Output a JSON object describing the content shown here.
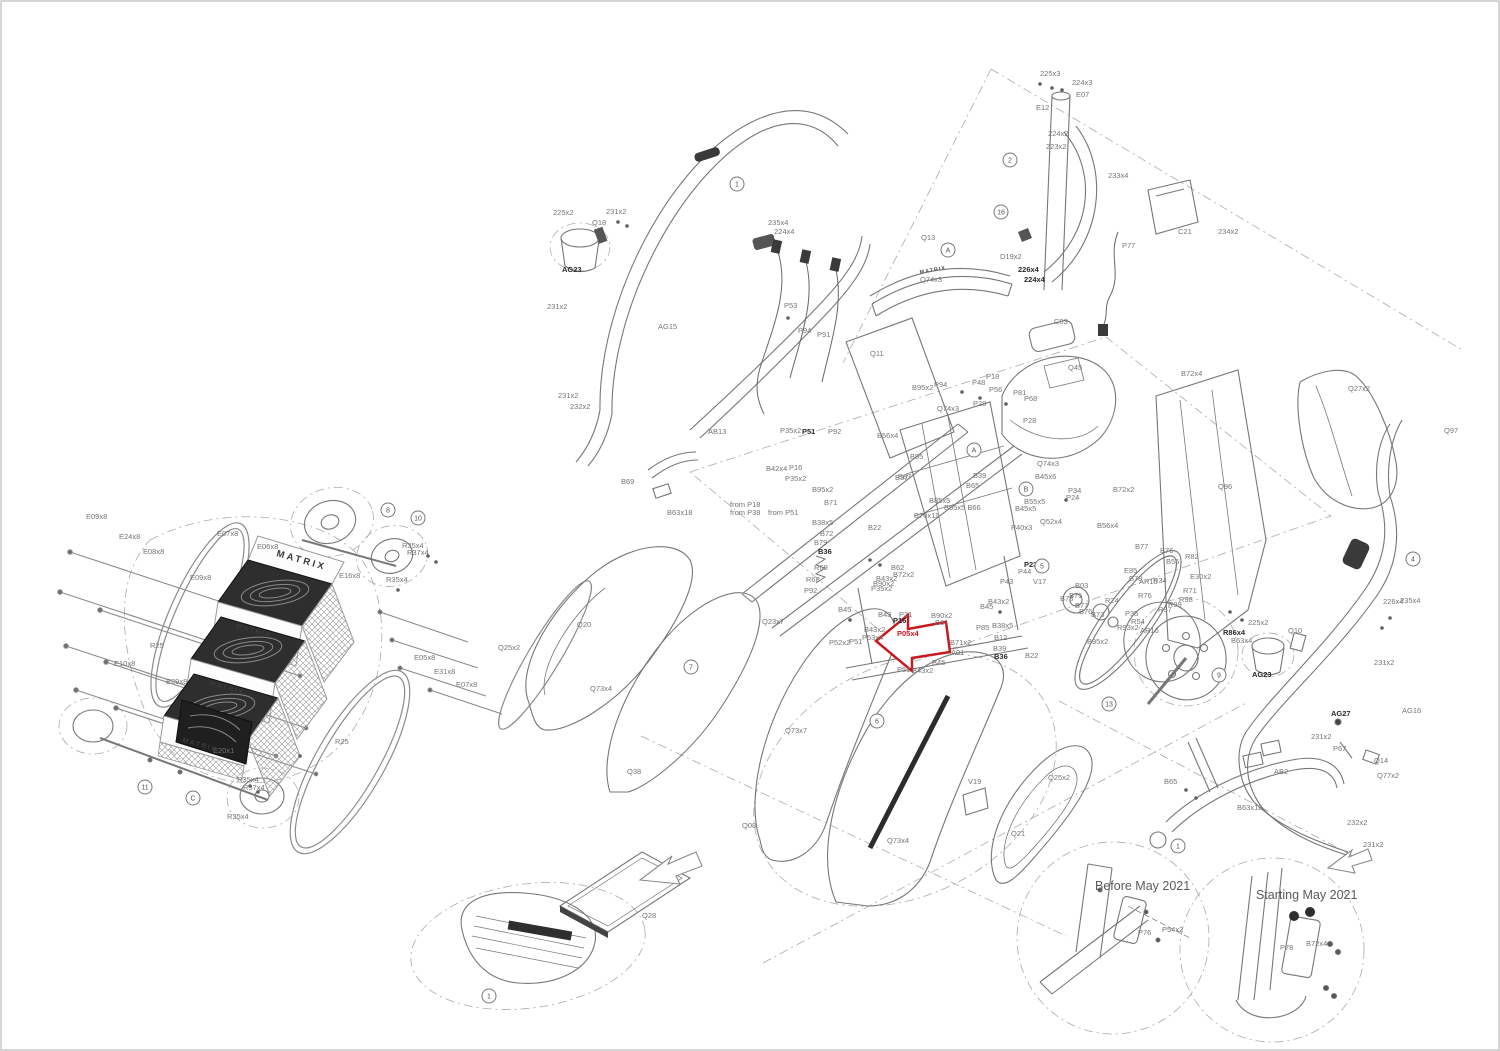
{
  "title": "Matrix stair climber - exploded parts diagram",
  "colors": {
    "line": "#777777",
    "label": "#757575",
    "bold": "#2a2a2a",
    "highlight": "#c8191f",
    "border": "#c9c9c9",
    "dark_fill": "#2e2e2e"
  },
  "highlight_arrow": {
    "points": "876,641 908,615 908,629 946,622 950,652 912,658 912,671"
  },
  "labels": [
    {
      "t": "225x3",
      "x": 1040,
      "y": 76
    },
    {
      "t": "224x3",
      "x": 1072,
      "y": 85
    },
    {
      "t": "E07",
      "x": 1076,
      "y": 97
    },
    {
      "t": "E12",
      "x": 1036,
      "y": 110
    },
    {
      "t": "224x2",
      "x": 1048,
      "y": 136
    },
    {
      "t": "223x2",
      "x": 1046,
      "y": 149
    },
    {
      "t": "233x4",
      "x": 1108,
      "y": 178
    },
    {
      "t": "C21",
      "x": 1178,
      "y": 234
    },
    {
      "t": "234x2",
      "x": 1218,
      "y": 234
    },
    {
      "t": "P77",
      "x": 1122,
      "y": 248
    },
    {
      "t": "D19x2",
      "x": 1000,
      "y": 259
    },
    {
      "t": "226x4",
      "x": 1018,
      "y": 272,
      "cls": "b"
    },
    {
      "t": "224x4",
      "x": 1024,
      "y": 282,
      "cls": "b"
    },
    {
      "t": "225x2",
      "x": 553,
      "y": 215
    },
    {
      "t": "231x2",
      "x": 606,
      "y": 214
    },
    {
      "t": "Q18",
      "x": 592,
      "y": 225
    },
    {
      "t": "235x4",
      "x": 768,
      "y": 225
    },
    {
      "t": "224x4",
      "x": 774,
      "y": 234
    },
    {
      "t": "AG23",
      "x": 562,
      "y": 272,
      "cls": "b"
    },
    {
      "t": "231x2",
      "x": 547,
      "y": 309
    },
    {
      "t": "AG15",
      "x": 658,
      "y": 329
    },
    {
      "t": "P53",
      "x": 784,
      "y": 308
    },
    {
      "t": "P94",
      "x": 798,
      "y": 333
    },
    {
      "t": "P91",
      "x": 817,
      "y": 337
    },
    {
      "t": "231x2",
      "x": 558,
      "y": 398
    },
    {
      "t": "232x2",
      "x": 570,
      "y": 409
    },
    {
      "t": "Q13",
      "x": 921,
      "y": 240
    },
    {
      "t": "Q74x3",
      "x": 920,
      "y": 282
    },
    {
      "t": "Q11",
      "x": 870,
      "y": 356
    },
    {
      "t": "C03",
      "x": 1054,
      "y": 324
    },
    {
      "t": "Q45",
      "x": 1068,
      "y": 370
    },
    {
      "t": "B95x2",
      "x": 912,
      "y": 390
    },
    {
      "t": "P94",
      "x": 934,
      "y": 387
    },
    {
      "t": "P48",
      "x": 972,
      "y": 385
    },
    {
      "t": "P18",
      "x": 986,
      "y": 379
    },
    {
      "t": "P56",
      "x": 989,
      "y": 392
    },
    {
      "t": "P81",
      "x": 1013,
      "y": 395
    },
    {
      "t": "P68",
      "x": 1024,
      "y": 401
    },
    {
      "t": "P28",
      "x": 973,
      "y": 406
    },
    {
      "t": "P28",
      "x": 1023,
      "y": 423
    },
    {
      "t": "B72x4",
      "x": 1181,
      "y": 376
    },
    {
      "t": "Q27x2",
      "x": 1348,
      "y": 391
    },
    {
      "t": "Q97",
      "x": 1444,
      "y": 433
    },
    {
      "t": "Q96",
      "x": 1218,
      "y": 489
    },
    {
      "t": "B72x2",
      "x": 1113,
      "y": 492
    },
    {
      "t": "AB13",
      "x": 708,
      "y": 434
    },
    {
      "t": "P35x2",
      "x": 780,
      "y": 433
    },
    {
      "t": "P51",
      "x": 802,
      "y": 434,
      "cls": "b"
    },
    {
      "t": "P92",
      "x": 828,
      "y": 434
    },
    {
      "t": "B56x4",
      "x": 877,
      "y": 438
    },
    {
      "t": "Q74x3",
      "x": 937,
      "y": 411
    },
    {
      "t": "B42x4",
      "x": 766,
      "y": 471
    },
    {
      "t": "P16",
      "x": 789,
      "y": 470
    },
    {
      "t": "P35x2",
      "x": 785,
      "y": 481
    },
    {
      "t": "B95x2",
      "x": 812,
      "y": 492
    },
    {
      "t": "B71",
      "x": 824,
      "y": 505
    },
    {
      "t": "from P18",
      "x": 730,
      "y": 507
    },
    {
      "t": "from P38",
      "x": 730,
      "y": 515
    },
    {
      "t": "from P51",
      "x": 768,
      "y": 515
    },
    {
      "t": "B38x5",
      "x": 812,
      "y": 525
    },
    {
      "t": "B72",
      "x": 820,
      "y": 536
    },
    {
      "t": "B79",
      "x": 814,
      "y": 545
    },
    {
      "t": "B36",
      "x": 818,
      "y": 554,
      "cls": "b"
    },
    {
      "t": "B37",
      "x": 895,
      "y": 480
    },
    {
      "t": "B22",
      "x": 868,
      "y": 530
    },
    {
      "t": "R69",
      "x": 814,
      "y": 570
    },
    {
      "t": "R68",
      "x": 806,
      "y": 582
    },
    {
      "t": "P92",
      "x": 804,
      "y": 593
    },
    {
      "t": "B95",
      "x": 910,
      "y": 459
    },
    {
      "t": "B87",
      "x": 898,
      "y": 479
    },
    {
      "t": "B85x5",
      "x": 929,
      "y": 503
    },
    {
      "t": "B55x5 B66",
      "x": 944,
      "y": 510
    },
    {
      "t": "B70x11",
      "x": 914,
      "y": 518
    },
    {
      "t": "B39",
      "x": 973,
      "y": 478
    },
    {
      "t": "B65",
      "x": 966,
      "y": 488
    },
    {
      "t": "Q74x3",
      "x": 1037,
      "y": 466
    },
    {
      "t": "B45x6",
      "x": 1035,
      "y": 479
    },
    {
      "t": "P34",
      "x": 1068,
      "y": 493
    },
    {
      "t": "P24",
      "x": 1066,
      "y": 500
    },
    {
      "t": "B55x5",
      "x": 1024,
      "y": 504
    },
    {
      "t": "B45x5",
      "x": 1015,
      "y": 511
    },
    {
      "t": "Q52x4",
      "x": 1040,
      "y": 524
    },
    {
      "t": "P40x3",
      "x": 1011,
      "y": 530
    },
    {
      "t": "B56x4",
      "x": 1097,
      "y": 528
    },
    {
      "t": "B62",
      "x": 891,
      "y": 570
    },
    {
      "t": "B72x2",
      "x": 893,
      "y": 577
    },
    {
      "t": "B43x2",
      "x": 876,
      "y": 581
    },
    {
      "t": "B90x2",
      "x": 873,
      "y": 586
    },
    {
      "t": "P35x2",
      "x": 871,
      "y": 591
    },
    {
      "t": "B45",
      "x": 838,
      "y": 612
    },
    {
      "t": "B43",
      "x": 878,
      "y": 617
    },
    {
      "t": "P31",
      "x": 899,
      "y": 617
    },
    {
      "t": "P16",
      "x": 893,
      "y": 623,
      "cls": "b"
    },
    {
      "t": "B90x2",
      "x": 931,
      "y": 618
    },
    {
      "t": "B61",
      "x": 935,
      "y": 625
    },
    {
      "t": "B43x2",
      "x": 864,
      "y": 632
    },
    {
      "t": "P53x4",
      "x": 862,
      "y": 640
    },
    {
      "t": "P05x4",
      "x": 897,
      "y": 636,
      "cls": "red"
    },
    {
      "t": "P52x2",
      "x": 829,
      "y": 645
    },
    {
      "t": "P51",
      "x": 849,
      "y": 644
    },
    {
      "t": "P51",
      "x": 897,
      "y": 672
    },
    {
      "t": "B43x2",
      "x": 912,
      "y": 673
    },
    {
      "t": "B45",
      "x": 932,
      "y": 665
    },
    {
      "t": "A01",
      "x": 951,
      "y": 655
    },
    {
      "t": "B71x2",
      "x": 950,
      "y": 645
    },
    {
      "t": "B43x2",
      "x": 988,
      "y": 604
    },
    {
      "t": "B45",
      "x": 980,
      "y": 609
    },
    {
      "t": "P85",
      "x": 976,
      "y": 630
    },
    {
      "t": "B38x5",
      "x": 992,
      "y": 628
    },
    {
      "t": "B12",
      "x": 994,
      "y": 640
    },
    {
      "t": "B39",
      "x": 993,
      "y": 651
    },
    {
      "t": "B36",
      "x": 994,
      "y": 659,
      "cls": "b"
    },
    {
      "t": "B22",
      "x": 1025,
      "y": 658
    },
    {
      "t": "P23",
      "x": 1024,
      "y": 567,
      "cls": "b"
    },
    {
      "t": "P44",
      "x": 1018,
      "y": 574
    },
    {
      "t": "P43",
      "x": 1000,
      "y": 584
    },
    {
      "t": "V17",
      "x": 1033,
      "y": 584
    },
    {
      "t": "B03",
      "x": 1075,
      "y": 588
    },
    {
      "t": "R24",
      "x": 1105,
      "y": 603
    },
    {
      "t": "B78",
      "x": 1060,
      "y": 601
    },
    {
      "t": "B75",
      "x": 1069,
      "y": 598
    },
    {
      "t": "B77",
      "x": 1075,
      "y": 608
    },
    {
      "t": "B76",
      "x": 1079,
      "y": 614
    },
    {
      "t": "B73",
      "x": 1091,
      "y": 617
    },
    {
      "t": "B77",
      "x": 1135,
      "y": 549
    },
    {
      "t": "B76",
      "x": 1160,
      "y": 553
    },
    {
      "t": "B55",
      "x": 1166,
      "y": 564
    },
    {
      "t": "R82",
      "x": 1185,
      "y": 559
    },
    {
      "t": "E85",
      "x": 1124,
      "y": 573
    },
    {
      "t": "B78",
      "x": 1129,
      "y": 581
    },
    {
      "t": "AR15",
      "x": 1139,
      "y": 584
    },
    {
      "t": "R34",
      "x": 1153,
      "y": 583
    },
    {
      "t": "E30x2",
      "x": 1190,
      "y": 579
    },
    {
      "t": "R71",
      "x": 1183,
      "y": 593
    },
    {
      "t": "R98",
      "x": 1179,
      "y": 602
    },
    {
      "t": "R99",
      "x": 1168,
      "y": 607
    },
    {
      "t": "R76",
      "x": 1138,
      "y": 598
    },
    {
      "t": "R97",
      "x": 1158,
      "y": 612
    },
    {
      "t": "P35",
      "x": 1125,
      "y": 616
    },
    {
      "t": "R54",
      "x": 1131,
      "y": 624
    },
    {
      "t": "AR16",
      "x": 1140,
      "y": 633
    },
    {
      "t": "R93x2",
      "x": 1117,
      "y": 630
    },
    {
      "t": "B95x2",
      "x": 1087,
      "y": 644
    },
    {
      "t": "R86x4",
      "x": 1223,
      "y": 635,
      "cls": "b"
    },
    {
      "t": "B63x4",
      "x": 1231,
      "y": 643
    },
    {
      "t": "225x2",
      "x": 1248,
      "y": 625
    },
    {
      "t": "Q10",
      "x": 1288,
      "y": 633
    },
    {
      "t": "AG23",
      "x": 1252,
      "y": 677,
      "cls": "b"
    },
    {
      "t": "226x4",
      "x": 1383,
      "y": 604
    },
    {
      "t": "235x4",
      "x": 1400,
      "y": 603
    },
    {
      "t": "231x2",
      "x": 1374,
      "y": 665
    },
    {
      "t": "AG27",
      "x": 1331,
      "y": 716,
      "cls": "b"
    },
    {
      "t": "AG16",
      "x": 1402,
      "y": 713
    },
    {
      "t": "231x2",
      "x": 1311,
      "y": 739
    },
    {
      "t": "P67",
      "x": 1333,
      "y": 751
    },
    {
      "t": "Q14",
      "x": 1374,
      "y": 763
    },
    {
      "t": "Q77x2",
      "x": 1377,
      "y": 778
    },
    {
      "t": "AB2",
      "x": 1274,
      "y": 774
    },
    {
      "t": "B65",
      "x": 1164,
      "y": 784
    },
    {
      "t": "B63x18",
      "x": 1237,
      "y": 810
    },
    {
      "t": "232x2",
      "x": 1347,
      "y": 825
    },
    {
      "t": "231x2",
      "x": 1363,
      "y": 847
    },
    {
      "t": "E09x8",
      "x": 86,
      "y": 519
    },
    {
      "t": "E24x8",
      "x": 119,
      "y": 539
    },
    {
      "t": "E08x8",
      "x": 143,
      "y": 554
    },
    {
      "t": "E07x8",
      "x": 217,
      "y": 536
    },
    {
      "t": "E06x8",
      "x": 257,
      "y": 549
    },
    {
      "t": "E09x8",
      "x": 190,
      "y": 580
    },
    {
      "t": "E16x8",
      "x": 339,
      "y": 578
    },
    {
      "t": "R25",
      "x": 150,
      "y": 648
    },
    {
      "t": "E10x8",
      "x": 114,
      "y": 666
    },
    {
      "t": "E29x8",
      "x": 166,
      "y": 684
    },
    {
      "t": "E05x8",
      "x": 414,
      "y": 660
    },
    {
      "t": "E31x8",
      "x": 434,
      "y": 674
    },
    {
      "t": "E07x8",
      "x": 456,
      "y": 687
    },
    {
      "t": "R25",
      "x": 335,
      "y": 744
    },
    {
      "t": "E20x1",
      "x": 213,
      "y": 753
    },
    {
      "t": "R35x4",
      "x": 402,
      "y": 548
    },
    {
      "t": "R37x4",
      "x": 407,
      "y": 555
    },
    {
      "t": "R35x4",
      "x": 386,
      "y": 582
    },
    {
      "t": "R35x4",
      "x": 237,
      "y": 782
    },
    {
      "t": "R37x4",
      "x": 243,
      "y": 790
    },
    {
      "t": "R35x4",
      "x": 227,
      "y": 819
    },
    {
      "t": "B69",
      "x": 621,
      "y": 484
    },
    {
      "t": "B63x18",
      "x": 667,
      "y": 515
    },
    {
      "t": "Q20",
      "x": 577,
      "y": 627
    },
    {
      "t": "Q25x2",
      "x": 498,
      "y": 650
    },
    {
      "t": "Q73x4",
      "x": 590,
      "y": 691
    },
    {
      "t": "Q23x7",
      "x": 762,
      "y": 624
    },
    {
      "t": "Q38",
      "x": 627,
      "y": 774
    },
    {
      "t": "Q73x7",
      "x": 785,
      "y": 733
    },
    {
      "t": "Q08",
      "x": 742,
      "y": 828
    },
    {
      "t": "V19",
      "x": 968,
      "y": 784
    },
    {
      "t": "Q73x4",
      "x": 887,
      "y": 843
    },
    {
      "t": "Q25x2",
      "x": 1048,
      "y": 780
    },
    {
      "t": "Q21",
      "x": 1011,
      "y": 836
    },
    {
      "t": "Q28",
      "x": 642,
      "y": 918
    },
    {
      "t": "Before May 2021",
      "x": 1095,
      "y": 890,
      "cls": "t2"
    },
    {
      "t": "P76",
      "x": 1138,
      "y": 935
    },
    {
      "t": "P54x2",
      "x": 1162,
      "y": 932
    },
    {
      "t": "Starting May 2021",
      "x": 1256,
      "y": 899,
      "cls": "t2"
    },
    {
      "t": "P78",
      "x": 1280,
      "y": 950
    },
    {
      "t": "B72x4",
      "x": 1306,
      "y": 946
    },
    {
      "t": "MATRIX",
      "x": 276,
      "y": 556,
      "cls": "brand big",
      "rot": 16
    },
    {
      "t": "MATRIX",
      "x": 236,
      "y": 628,
      "cls": "brand",
      "rot": 16
    },
    {
      "t": "MATRIX",
      "x": 209,
      "y": 685,
      "cls": "brand",
      "rot": 16
    },
    {
      "t": "MATRIX",
      "x": 182,
      "y": 742,
      "cls": "brand",
      "rot": 16
    },
    {
      "t": "MATRIX",
      "x": 920,
      "y": 274,
      "cls": "brand sm",
      "rot": -10
    }
  ],
  "callouts": [
    {
      "n": "1",
      "x": 489,
      "y": 996
    },
    {
      "n": "1",
      "x": 737,
      "y": 184
    },
    {
      "n": "2",
      "x": 1010,
      "y": 160
    },
    {
      "n": "16",
      "x": 1001,
      "y": 212
    },
    {
      "n": "A",
      "x": 948,
      "y": 250
    },
    {
      "n": "A",
      "x": 974,
      "y": 450
    },
    {
      "n": "B",
      "x": 1026,
      "y": 489
    },
    {
      "n": "5",
      "x": 1042,
      "y": 566
    },
    {
      "n": "4",
      "x": 1413,
      "y": 559
    },
    {
      "n": "6",
      "x": 877,
      "y": 721
    },
    {
      "n": "7",
      "x": 691,
      "y": 667
    },
    {
      "n": "8",
      "x": 388,
      "y": 510
    },
    {
      "n": "9",
      "x": 1219,
      "y": 675
    },
    {
      "n": "10",
      "x": 418,
      "y": 518
    },
    {
      "n": "11",
      "x": 145,
      "y": 787
    },
    {
      "n": "C",
      "x": 193,
      "y": 798
    },
    {
      "n": "13",
      "x": 1109,
      "y": 704
    },
    {
      "n": "1",
      "x": 1178,
      "y": 846
    }
  ]
}
